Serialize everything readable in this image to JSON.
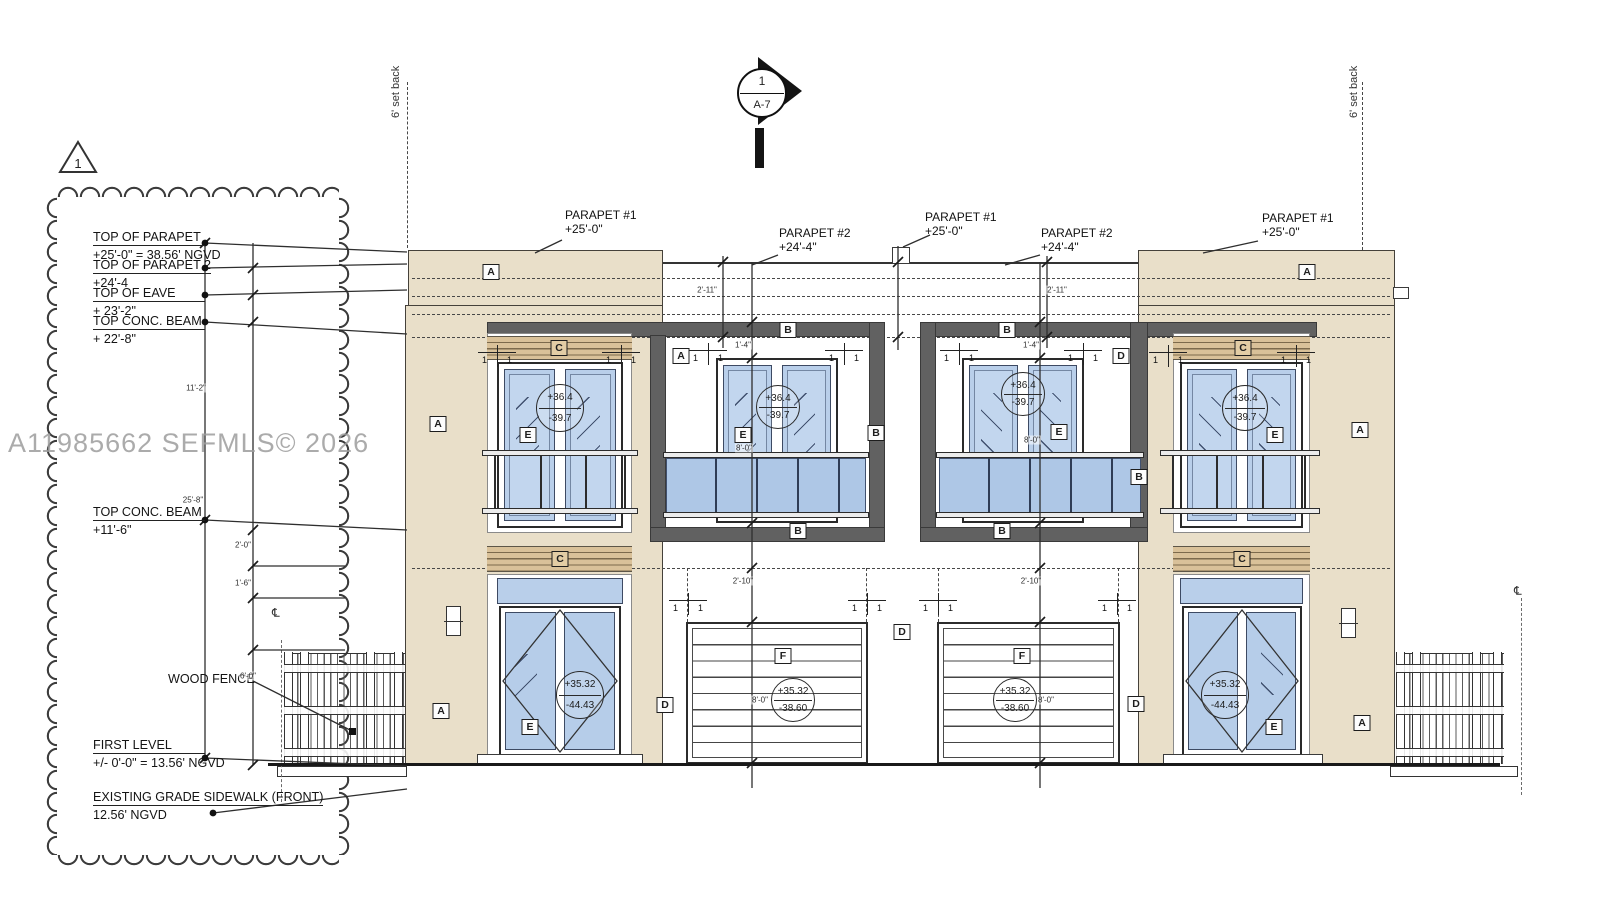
{
  "sheet": {
    "watermark": "A11985662  SEFMLS© 2026"
  },
  "markers": {
    "revision_triangle": "1",
    "section_circle_top": "1",
    "section_circle_bottom": "A-7",
    "setback_left": "6' set back",
    "setback_right": "6' set back",
    "wood_fence_label": "WOOD FENCE",
    "centerline_left": "℄",
    "centerline_right": "℄"
  },
  "elevation_labels": [
    {
      "name": "TOP OF PARAPET",
      "value": "+25'-0\" = 38.56' NGVD",
      "y": 230,
      "w": 112,
      "dot_y": 243
    },
    {
      "name": "TOP OF PARAPET 2",
      "value": "+24'-4",
      "y": 258,
      "w": 112,
      "dot_y": 268
    },
    {
      "name": "TOP OF EAVE",
      "value": "+ 23'-2\"",
      "y": 286,
      "w": 112,
      "dot_y": 295
    },
    {
      "name": "TOP CONC. BEAM",
      "value": "+ 22'-8\"",
      "y": 314,
      "w": 112,
      "dot_y": 322
    },
    {
      "name": "TOP CONC. BEAM",
      "value": "+11'-6\"",
      "y": 505,
      "w": 112,
      "dot_y": 520
    },
    {
      "name": "FIRST LEVEL",
      "value": "+/- 0'-0\" = 13.56' NGVD",
      "y": 738,
      "w": 112,
      "dot_y": 758
    },
    {
      "name": "EXISTING GRADE SIDEWALK (FRONT)",
      "value": "12.56' NGVD",
      "y": 790,
      "w": 120,
      "dot_y": 813
    }
  ],
  "parapet_callouts": [
    {
      "line1": "PARAPET #1",
      "line2": "+25'-0\"",
      "x": 565,
      "y": 208
    },
    {
      "line1": "PARAPET #2",
      "line2": "+24'-4\"",
      "x": 779,
      "y": 226
    },
    {
      "line1": "PARAPET #1",
      "line2": "+25'-0\"",
      "x": 925,
      "y": 210
    },
    {
      "line1": "PARAPET #2",
      "line2": "+24'-4\"",
      "x": 1041,
      "y": 226
    },
    {
      "line1": "PARAPET #1",
      "line2": "+25'-0\"",
      "x": 1262,
      "y": 211
    }
  ],
  "tags": [
    {
      "t": "A",
      "x": 491,
      "y": 272
    },
    {
      "t": "A",
      "x": 1307,
      "y": 272
    },
    {
      "t": "A",
      "x": 438,
      "y": 424
    },
    {
      "t": "A",
      "x": 1360,
      "y": 430
    },
    {
      "t": "A",
      "x": 441,
      "y": 711
    },
    {
      "t": "A",
      "x": 1362,
      "y": 723
    },
    {
      "t": "A",
      "x": 681,
      "y": 356
    },
    {
      "t": "B",
      "x": 788,
      "y": 330
    },
    {
      "t": "B",
      "x": 1007,
      "y": 330
    },
    {
      "t": "B",
      "x": 876,
      "y": 433
    },
    {
      "t": "B",
      "x": 1139,
      "y": 477
    },
    {
      "t": "B",
      "x": 798,
      "y": 531
    },
    {
      "t": "B",
      "x": 1002,
      "y": 531
    },
    {
      "t": "C",
      "x": 559,
      "y": 348
    },
    {
      "t": "C",
      "x": 1243,
      "y": 348
    },
    {
      "t": "C",
      "x": 560,
      "y": 559
    },
    {
      "t": "C",
      "x": 1242,
      "y": 559
    },
    {
      "t": "D",
      "x": 1121,
      "y": 356
    },
    {
      "t": "D",
      "x": 665,
      "y": 705
    },
    {
      "t": "D",
      "x": 902,
      "y": 632
    },
    {
      "t": "D",
      "x": 1136,
      "y": 704
    },
    {
      "t": "E",
      "x": 528,
      "y": 435
    },
    {
      "t": "E",
      "x": 743,
      "y": 435
    },
    {
      "t": "E",
      "x": 1059,
      "y": 432
    },
    {
      "t": "E",
      "x": 1275,
      "y": 435
    },
    {
      "t": "E",
      "x": 530,
      "y": 727
    },
    {
      "t": "E",
      "x": 1274,
      "y": 727
    },
    {
      "t": "F",
      "x": 783,
      "y": 656
    },
    {
      "t": "F",
      "x": 1022,
      "y": 656
    }
  ],
  "spot_elevations": [
    {
      "top": "+36.4",
      "bottom": "-39.7",
      "x": 560,
      "y": 408,
      "r": 23
    },
    {
      "top": "+36.4",
      "bottom": "-39.7",
      "x": 778,
      "y": 407,
      "r": 21
    },
    {
      "top": "+36.4",
      "bottom": "-39.7",
      "x": 1023,
      "y": 394,
      "r": 21
    },
    {
      "top": "+36.4",
      "bottom": "-39.7",
      "x": 1245,
      "y": 408,
      "r": 22
    },
    {
      "top": "+35.32",
      "bottom": "-44.43",
      "x": 580,
      "y": 695,
      "r": 23
    },
    {
      "top": "+35.32",
      "bottom": "-38.60",
      "x": 793,
      "y": 700,
      "r": 21
    },
    {
      "top": "+35.32",
      "bottom": "-38.60",
      "x": 1015,
      "y": 700,
      "r": 21
    },
    {
      "top": "+35.32",
      "bottom": "-44.43",
      "x": 1225,
      "y": 695,
      "r": 23
    }
  ],
  "tick_pairs": [
    {
      "a": "1",
      "b": "1",
      "x": 497,
      "y": 352
    },
    {
      "a": "1",
      "b": "1",
      "x": 621,
      "y": 352
    },
    {
      "a": "1",
      "b": "1",
      "x": 708,
      "y": 350
    },
    {
      "a": "1",
      "b": "1",
      "x": 844,
      "y": 350
    },
    {
      "a": "1",
      "b": "1",
      "x": 959,
      "y": 350
    },
    {
      "a": "1",
      "b": "1",
      "x": 1083,
      "y": 350
    },
    {
      "a": "1",
      "b": "1",
      "x": 1168,
      "y": 352
    },
    {
      "a": "1",
      "b": "1",
      "x": 1296,
      "y": 352
    },
    {
      "a": "1",
      "b": "1",
      "x": 688,
      "y": 600
    },
    {
      "a": "1",
      "b": "1",
      "x": 867,
      "y": 600
    },
    {
      "a": "1",
      "b": "1",
      "x": 938,
      "y": 600
    },
    {
      "a": "1",
      "b": "1",
      "x": 1117,
      "y": 600
    }
  ],
  "dims": [
    {
      "t": "2'-11\"",
      "x": 707,
      "y": 290
    },
    {
      "t": "2'-11\"",
      "x": 1057,
      "y": 290
    },
    {
      "t": "1'-4\"",
      "x": 743,
      "y": 345
    },
    {
      "t": "1'-4\"",
      "x": 1031,
      "y": 345
    },
    {
      "t": "8'-0\"",
      "x": 744,
      "y": 448
    },
    {
      "t": "8'-0\"",
      "x": 1032,
      "y": 440
    },
    {
      "t": "2'-10\"",
      "x": 743,
      "y": 581
    },
    {
      "t": "2'-10\"",
      "x": 1031,
      "y": 581
    },
    {
      "t": "8'-0\"",
      "x": 760,
      "y": 700
    },
    {
      "t": "8'-0\"",
      "x": 1046,
      "y": 700
    },
    {
      "t": "11'-2\"",
      "x": 196,
      "y": 388
    },
    {
      "t": "25'-8\"",
      "x": 193,
      "y": 500
    },
    {
      "t": "2'-0\"",
      "x": 243,
      "y": 545
    },
    {
      "t": "1'-6\"",
      "x": 243,
      "y": 583
    },
    {
      "t": "6'-0\"",
      "x": 248,
      "y": 676
    }
  ]
}
